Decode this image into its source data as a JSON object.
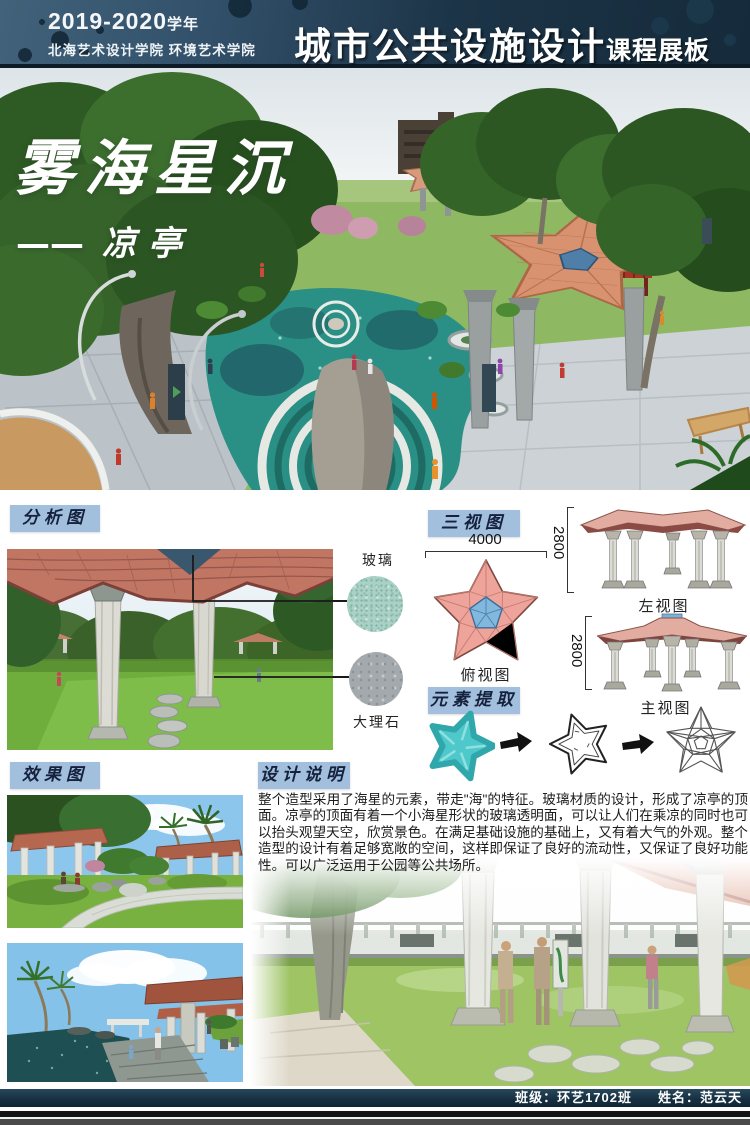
{
  "header": {
    "year": "2019-2020",
    "year_suffix": "学年",
    "school": "北海艺术设计学院 环境艺术学院",
    "course_title": "城市公共设施设计",
    "course_suffix": "课程展板"
  },
  "hero": {
    "title": "雾海星沉",
    "subtitle_dash": "——",
    "subtitle": "凉亭"
  },
  "sections": {
    "analysis_label": "分析图",
    "three_views_label": "三视图",
    "element_extract_label": "元素提取",
    "effect_label": "效果图",
    "description_label": "设计说明"
  },
  "materials": {
    "glass": "玻璃",
    "marble": "大理石"
  },
  "three_views": {
    "width_dim": "4000",
    "height_dim_left": "2800",
    "height_dim_main": "2800",
    "top_view_caption": "俯视图",
    "left_view_caption": "左视图",
    "main_view_caption": "主视图"
  },
  "description": {
    "text": "整个造型采用了海星的元素，带走\"海\"的特征。玻璃材质的设计，形成了凉亭的顶面。凉亭的顶面有着一个小海星形状的玻璃透明面，可以让人们在乘凉的同时也可以抬头观望天空，欣赏景色。在满足基础设施的基础上，又有着大气的外观。整个造型的设计有着足够宽敞的空间，这样即保证了良好的流动性，又保证了良好功能性。可以广泛运用于公园等公共场所。"
  },
  "footer": {
    "class_label": "班级：环艺1702班",
    "name_label": "姓名：范云天"
  },
  "colors": {
    "header_bg": "#1c3447",
    "label_bg": "#a3bfde",
    "roof_salmon": "#e0997c",
    "glass_blue": "#6fa8d6",
    "water_teal": "#2a8f84",
    "starfish_teal": "#45c0c6"
  }
}
